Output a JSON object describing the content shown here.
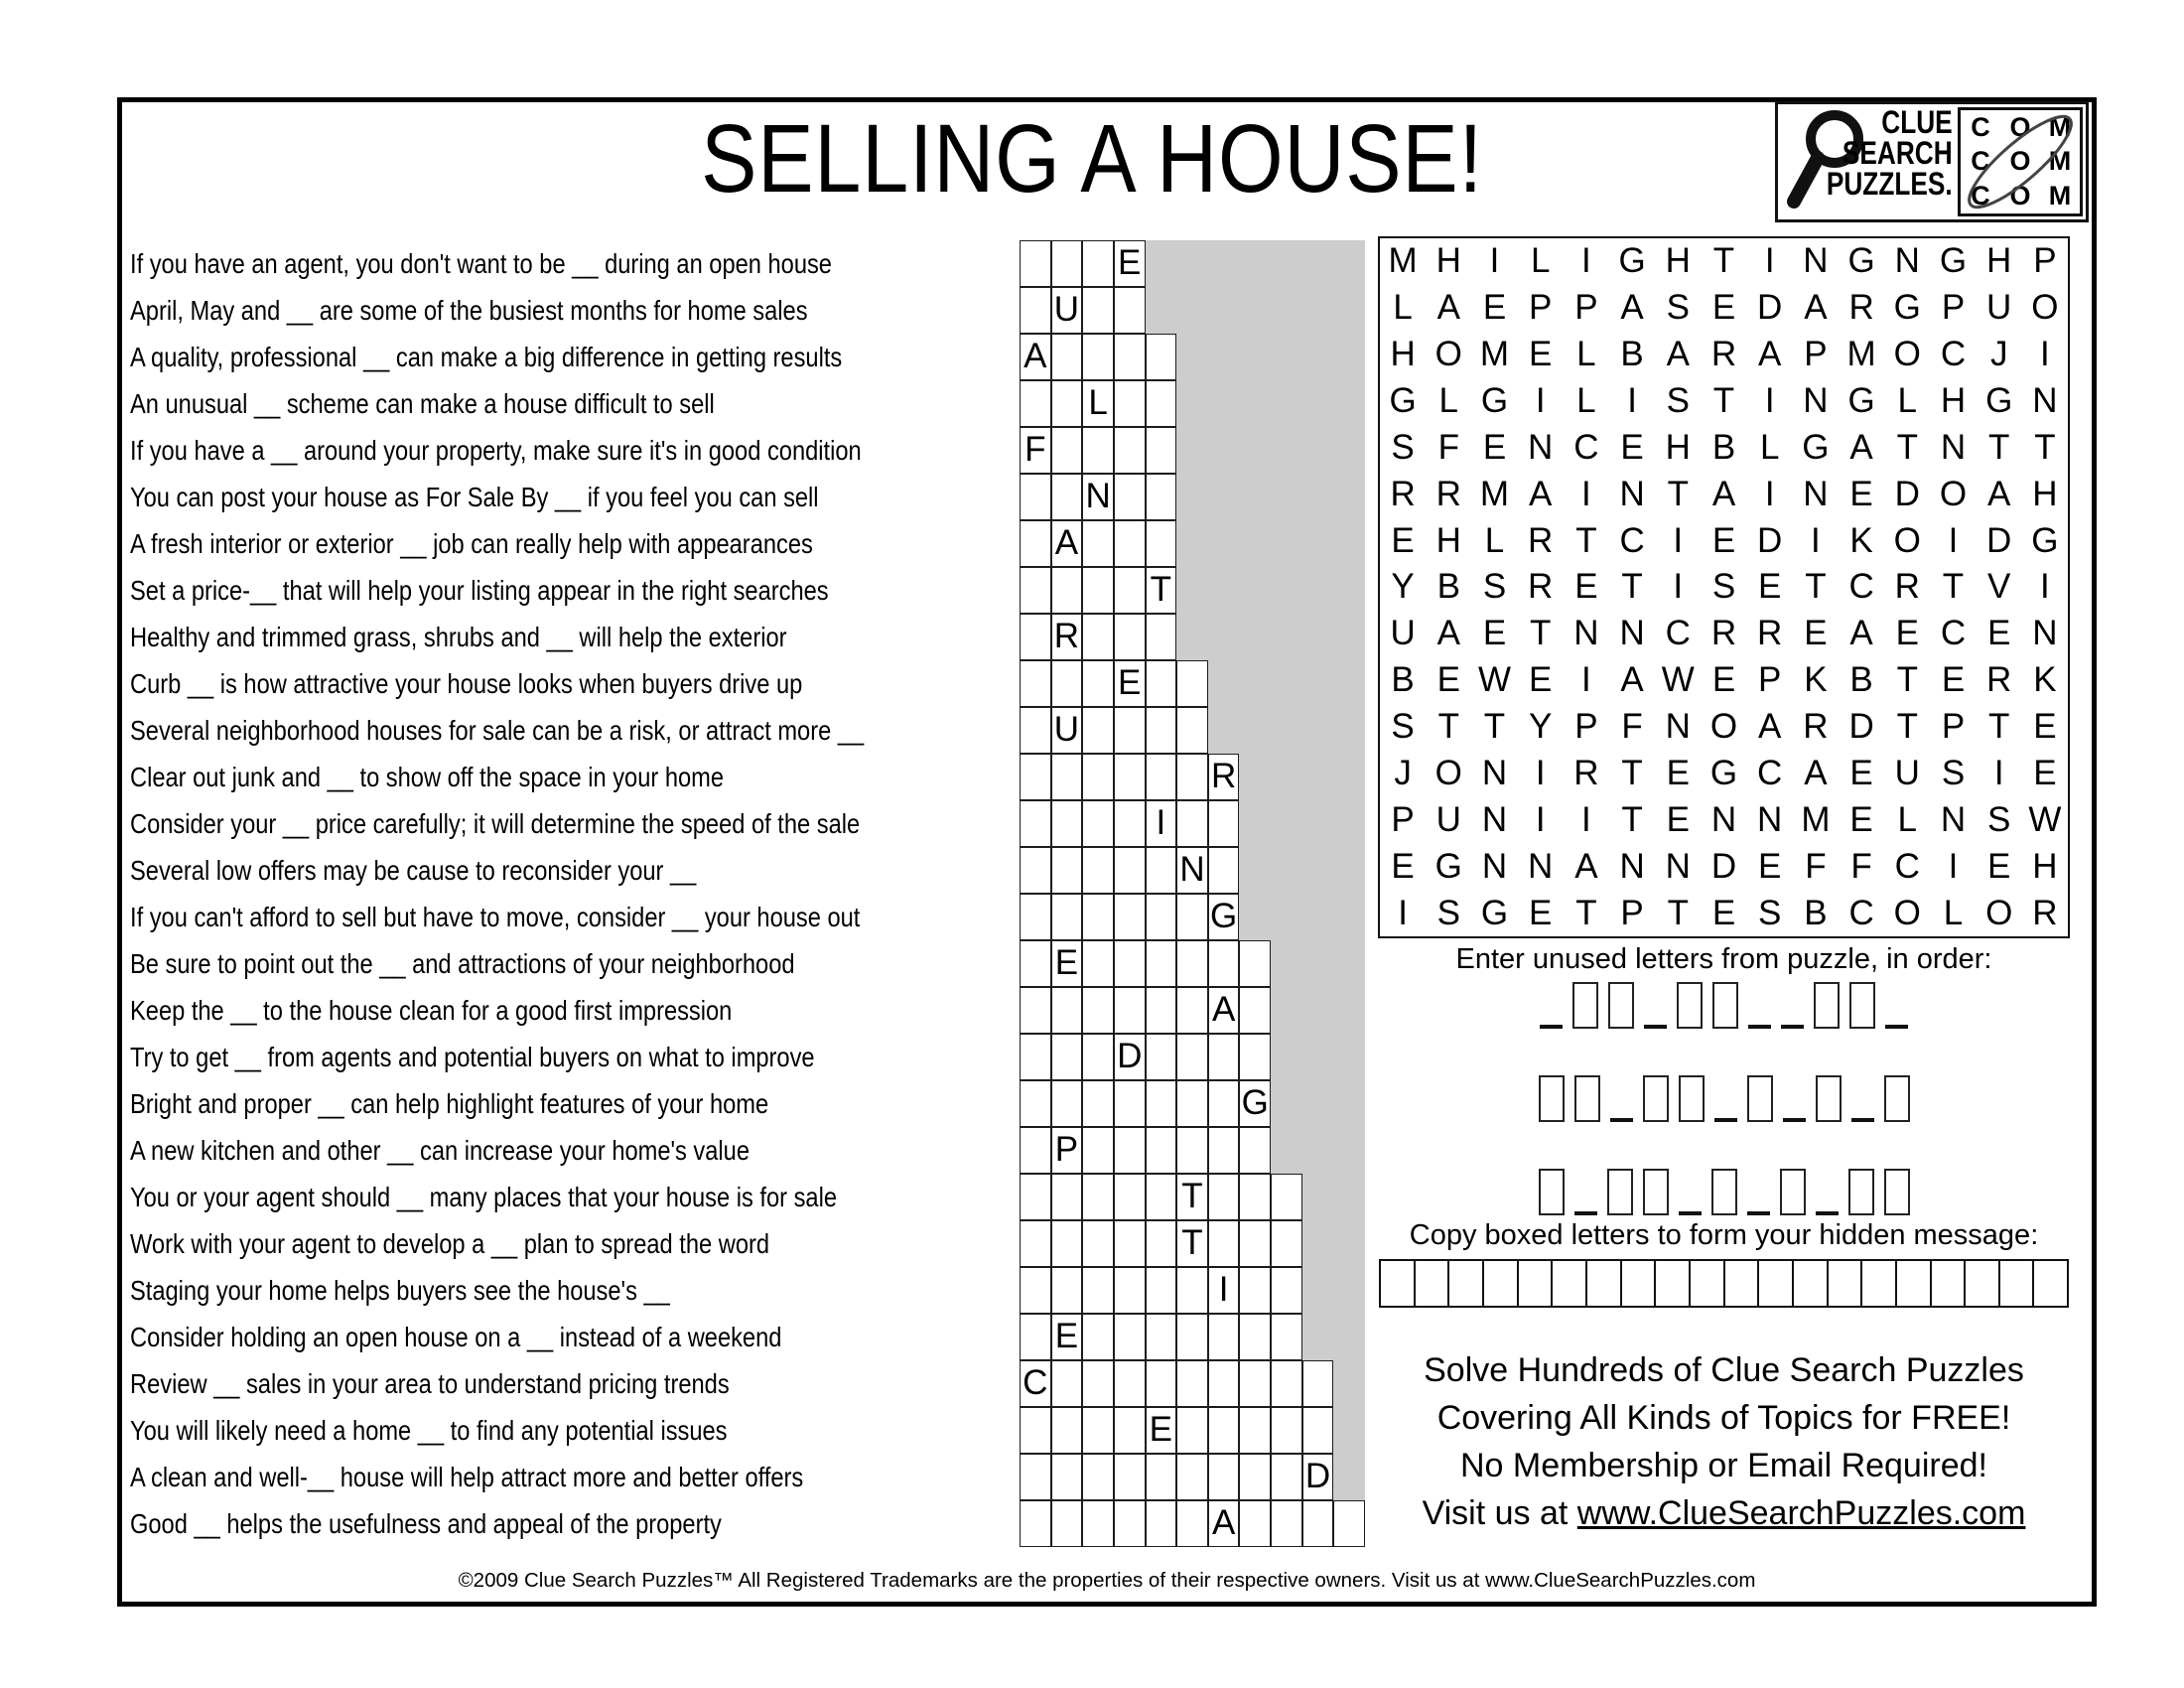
{
  "title": "SELLING A HOUSE!",
  "logo": {
    "line1": "CLUE",
    "line2": "SEARCH",
    "line3": "PUZZLES.",
    "com_rows": [
      [
        "C",
        "O",
        "M"
      ],
      [
        "C",
        "O",
        "M"
      ],
      [
        "C",
        "O",
        "M"
      ]
    ]
  },
  "clues": [
    "If you have an agent, you don't want to be __ during an open house",
    "April, May and __ are some of the busiest months for home sales",
    "A quality, professional __ can make a big difference in getting results",
    "An unusual __ scheme can make a house difficult to sell",
    "If you have a __ around your property, make sure it's in good condition",
    "You can post your house as For Sale By __ if you feel you can sell",
    "A fresh interior or exterior __ job can really help with appearances",
    "Set a price-__ that will help your listing appear in the right searches",
    "Healthy and trimmed grass, shrubs and __ will help the exterior",
    "Curb __ is how attractive your house looks when buyers drive up",
    "Several neighborhood houses for sale can be a risk, or attract more __",
    "Clear out junk and __ to show off the space in your home",
    "Consider your __ price carefully; it will determine the speed of the sale",
    "Several low offers may be cause to reconsider your __",
    "If you can't afford to sell but have to move, consider __ your house out",
    "Be sure to point out the __ and attractions of your neighborhood",
    "Keep the __ to the house clean for a good first impression",
    "Try to get __ from agents and potential buyers on what to improve",
    "Bright and proper __ can help highlight features of your home",
    "A new kitchen and other __ can increase your home's value",
    "You or your agent should __ many places that your house is for sale",
    "Work with your agent to develop a __ plan to spread the word",
    "Staging your home helps buyers see the house's __",
    "Consider holding an open house on a __ instead of a weekend",
    "Review __ sales in your area to understand pricing trends",
    "You will likely need a home __ to find any potential issues",
    "A clean and well-__ house will help attract more and better offers",
    "Good __ helps the usefulness and appeal of the property"
  ],
  "crossword": {
    "columns": 11,
    "rows": [
      {
        "len": 4,
        "letter": "E",
        "pos": 4
      },
      {
        "len": 4,
        "letter": "U",
        "pos": 2
      },
      {
        "len": 5,
        "letter": "A",
        "pos": 1
      },
      {
        "len": 5,
        "letter": "L",
        "pos": 3
      },
      {
        "len": 5,
        "letter": "F",
        "pos": 1
      },
      {
        "len": 5,
        "letter": "N",
        "pos": 3
      },
      {
        "len": 5,
        "letter": "A",
        "pos": 2
      },
      {
        "len": 5,
        "letter": "T",
        "pos": 5
      },
      {
        "len": 5,
        "letter": "R",
        "pos": 2
      },
      {
        "len": 6,
        "letter": "E",
        "pos": 4
      },
      {
        "len": 6,
        "letter": "U",
        "pos": 2
      },
      {
        "len": 7,
        "letter": "R",
        "pos": 7
      },
      {
        "len": 7,
        "letter": "I",
        "pos": 5
      },
      {
        "len": 7,
        "letter": "N",
        "pos": 6
      },
      {
        "len": 7,
        "letter": "G",
        "pos": 7
      },
      {
        "len": 8,
        "letter": "E",
        "pos": 2
      },
      {
        "len": 8,
        "letter": "A",
        "pos": 7
      },
      {
        "len": 8,
        "letter": "D",
        "pos": 4
      },
      {
        "len": 8,
        "letter": "G",
        "pos": 8
      },
      {
        "len": 8,
        "letter": "P",
        "pos": 2
      },
      {
        "len": 9,
        "letter": "T",
        "pos": 6
      },
      {
        "len": 9,
        "letter": "T",
        "pos": 6
      },
      {
        "len": 9,
        "letter": "I",
        "pos": 7
      },
      {
        "len": 9,
        "letter": "E",
        "pos": 2
      },
      {
        "len": 10,
        "letter": "C",
        "pos": 1
      },
      {
        "len": 10,
        "letter": "E",
        "pos": 5
      },
      {
        "len": 10,
        "letter": "D",
        "pos": 10
      },
      {
        "len": 11,
        "letter": "A",
        "pos": 7
      }
    ]
  },
  "wordsearch": {
    "rows": [
      "MHILIGHTINGNGHP",
      "LAEPPASEDARGPUO",
      "HOMELBARAPMOCJI",
      "GLGILISTINGLHGN",
      "SFENCEHBLGATNTT",
      "RRMAINTAINEDOAH",
      "EHLRTCIEDIKOIDG",
      "YBSRETISETCRTVI",
      "UAETNNCRREAECEN",
      "BEWEIAWEPKBTERK",
      "STTYPFNOARDTPTE",
      "JONIRTEGCAEUSIE",
      "PUNIITENNMELNSW",
      "EGNNANNDEFFCIEH",
      "ISGETPTESBCOLOR"
    ]
  },
  "unused_letters": {
    "label": "Enter unused letters from puzzle, in order:",
    "rows": [
      [
        "line",
        "box",
        "box",
        "line",
        "box",
        "box",
        "line",
        "line",
        "box",
        "box",
        "line"
      ],
      [
        "box",
        "box",
        "line",
        "box",
        "box",
        "line",
        "box",
        "line",
        "box",
        "line",
        "box"
      ],
      [
        "box",
        "line",
        "box",
        "box",
        "line",
        "box",
        "line",
        "box",
        "line",
        "box",
        "box"
      ]
    ]
  },
  "hidden_message": {
    "label": "Copy boxed letters to form your hidden message:",
    "cells": 20
  },
  "promo": {
    "lines": [
      "Solve Hundreds of Clue Search Puzzles",
      "Covering All Kinds of Topics for FREE!",
      "No Membership or Email Required!"
    ],
    "visit_prefix": "Visit us at ",
    "visit_link": "www.ClueSearchPuzzles.com"
  },
  "footer": "©2009 Clue Search Puzzles™ All Registered Trademarks are the properties of their respective owners. Visit us at www.ClueSearchPuzzles.com",
  "colors": {
    "grid_gray": "#cdcdcd",
    "ink": "#000000"
  }
}
